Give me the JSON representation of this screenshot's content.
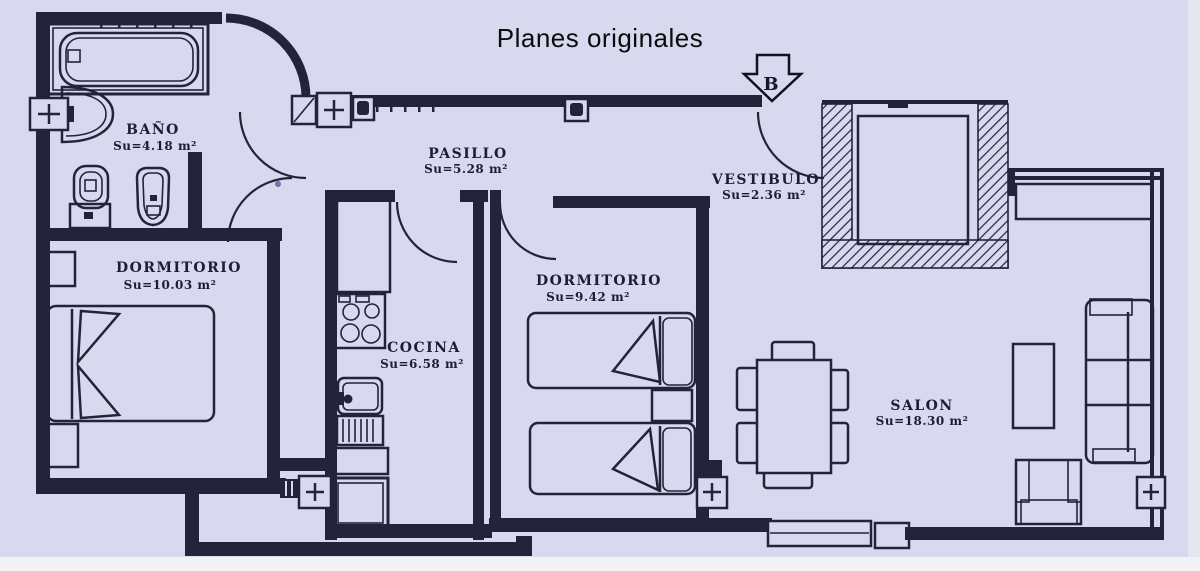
{
  "title": "Planes originales",
  "compass": {
    "label": "B"
  },
  "rooms": [
    {
      "id": "bano",
      "name": "BAÑO",
      "area": "Su=4.18 m²"
    },
    {
      "id": "pasillo",
      "name": "PASILLO",
      "area": "Su=5.28 m²"
    },
    {
      "id": "vestibulo",
      "name": "VESTIBULO",
      "area": "Su=2.36 m²"
    },
    {
      "id": "dormitorio1",
      "name": "DORMITORIO",
      "area": "Su=10.03 m²"
    },
    {
      "id": "dormitorio2",
      "name": "DORMITORIO",
      "area": "Su=9.42 m²"
    },
    {
      "id": "cocina",
      "name": "COCINA",
      "area": "Su=6.58 m²"
    },
    {
      "id": "salon",
      "name": "SALON",
      "area": "Su=18.30 m²"
    }
  ],
  "fixtures": [
    "bathtub",
    "washbasin",
    "toilet",
    "bidet",
    "radiator",
    "stove",
    "kitchen-sink",
    "kitchen-counter",
    "kitchen-table",
    "double-bed",
    "single-bed",
    "nightstand",
    "dining-table",
    "chair",
    "sofa",
    "coffee-table",
    "armchair",
    "sideboard",
    "elevator-shaft",
    "entrance-door",
    "balcony"
  ],
  "colors": {
    "paper": "#d8d9ee",
    "ink": "#23233a",
    "title_ink": "#0b0b0b"
  }
}
